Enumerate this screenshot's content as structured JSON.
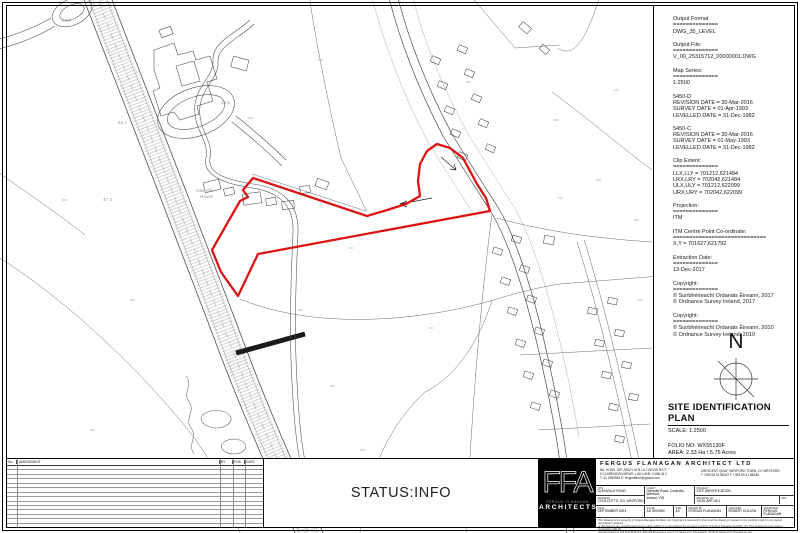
{
  "info_panel": {
    "blocks": [
      [
        "Output Format",
        "==============",
        "DWG_35_LEVEL"
      ],
      [
        "Output File:",
        "==============",
        "V_00_25315712_00000001.DWG"
      ],
      [
        "Map Series:",
        "==============",
        "1:2500"
      ],
      [
        "5450-D",
        "REVISION DATE = 30-Mar-2016",
        "SURVEY DATE   = 01-Apr-1993",
        "LEVELLED DATE = 31-Dec-1982"
      ],
      [
        "5450-C",
        "REVISION DATE = 30-Mar-2016",
        "SURVEY DATE   = 01-May-1993",
        "LEVELLED DATE = 31-Dec-1982"
      ],
      [
        "Clip Extent:",
        "==============",
        "LLX,LLY = 701212,621484",
        "LRX,LRY = 702042,621484",
        "ULX,ULY = 701212,622099",
        "URX,URY = 702042,622099"
      ],
      [
        "Projection:",
        "==============",
        "ITM"
      ],
      [
        "ITM Centre Point Co-ordinate:",
        "=============================",
        "X,Y = 701627,621792"
      ],
      [
        "Extraction Date:",
        "==============",
        "13-Dec-2017"
      ],
      [
        "Copyright:",
        "==============",
        "© Suirbhéireacht Ordanáis Éireann, 2017",
        "© Ordnance Survey Ireland, 2017"
      ],
      [
        "Copyright:",
        "==============",
        "© Suirbhéireacht Ordanáis Éireann, 2010",
        "© Ordnance Survey Ireland, 2010"
      ]
    ]
  },
  "compass": {
    "label": "N"
  },
  "plan_title": {
    "title": "SITE IDENTIFICATION PLAN",
    "scale": "SCALE: 1:2500",
    "folio": "FOLIO NO: WX55130F",
    "area": "AREA: 2.33 Ha / 5.75 Acres",
    "warning": "NOT FOR LAND REGISTRY PURPOSES",
    "warning_color": "#c74040"
  },
  "status_bar": {
    "status": "STATUS:INFO"
  },
  "revision_table": {
    "headers": [
      "No.",
      "AMENDMENT",
      "BY",
      "CHK",
      "DATE"
    ],
    "row_count": 13
  },
  "logo": {
    "monogram": "FFA",
    "name": "FERGUS FLANAGAN",
    "type": "ARCHITECTS"
  },
  "title_block": {
    "firm": "FERGUS FLANAGAN ARCHITECT LTD",
    "credentials": "BA. HONS. DIP. ARCH. M.R.I.A.I. ARCHITECT",
    "dublin_address": "5 CLARENDON MEWS, LAD LANE, DUBLIN 2",
    "dublin_contact": "T: 01 5383954    E: fergusffarch@gmail.com",
    "wexford_address": "CRESCENT QUAY, WEXFORD TOWN, CO WEXFORD",
    "wexford_contact": "T +353 53 91 88447  F +353 53 91 88448",
    "fields": {
      "site_label": "SITE",
      "site_value": "GLENVILLE ROAD",
      "townland_label": "ADDRESS",
      "townland_value": "COOLCOTTS, CO. WEXFORD",
      "client_label": "CLIENT",
      "client_value": "Glenville Road, Coolcotts, Wexford,\nIreland, Y35",
      "project_label": "PROJECT",
      "project_value": "SITE IDENTIFICATION",
      "drawing_no_label": "DRAWING NO",
      "drawing_no_value": "TAOS-ART-05.1",
      "rev_label": "REV",
      "rev_value": "",
      "date_label": "DATE",
      "date_value": "SEPTEMBER 2023",
      "scale_label": "SCALE",
      "scale_value": "AS SHOWN",
      "size_label": "SIZE",
      "size_value": "A3",
      "drawn_label": "DRAWN BY",
      "drawn_value": "FERGUS FLANAGAN",
      "checked_label": "CHECKED",
      "checked_value": "ROBERT CULLEN",
      "approved_label": "APPROVED",
      "approved_value": "FERGUS FLANAGAN"
    },
    "disclaimer_1": "This drawing is the property of Fergus Flanagan Architect Ltd. Copyright is reserved by them and the drawing is issued on the condition that it is not copied, reproduced, retained",
    "disclaimer_2": "or disclosed to any unauthorised person either wholly or in part without the consent in writing of Fergus Flanagan Architect Ltd. This drawing is to be read in conjunction with all",
    "disclaimer_3": "relevant drawings and specifications. Figured dimensions only to be taken from this drawing. All dimensions to be checked on site."
  },
  "map": {
    "boundary_color": "#dd1414",
    "site_boundary_points": "253,178 243,190 248,197 240,201 212,250 221,272 238,296 258,254 490,211 486,198 477,184 463,158 450,148 437,144 427,151 420,164 418,181 420,196 406,204 384,211 367,216",
    "labels": [
      {
        "text": "Glenville",
        "x": 196,
        "y": 188
      },
      {
        "text": "House",
        "x": 200,
        "y": 194
      },
      {
        "text": "49.9",
        "x": 62,
        "y": 18
      },
      {
        "text": "48.1",
        "x": 118,
        "y": 120
      },
      {
        "text": "47.4",
        "x": 103,
        "y": 197
      },
      {
        "text": "10.5",
        "x": 221,
        "y": 100
      }
    ]
  }
}
